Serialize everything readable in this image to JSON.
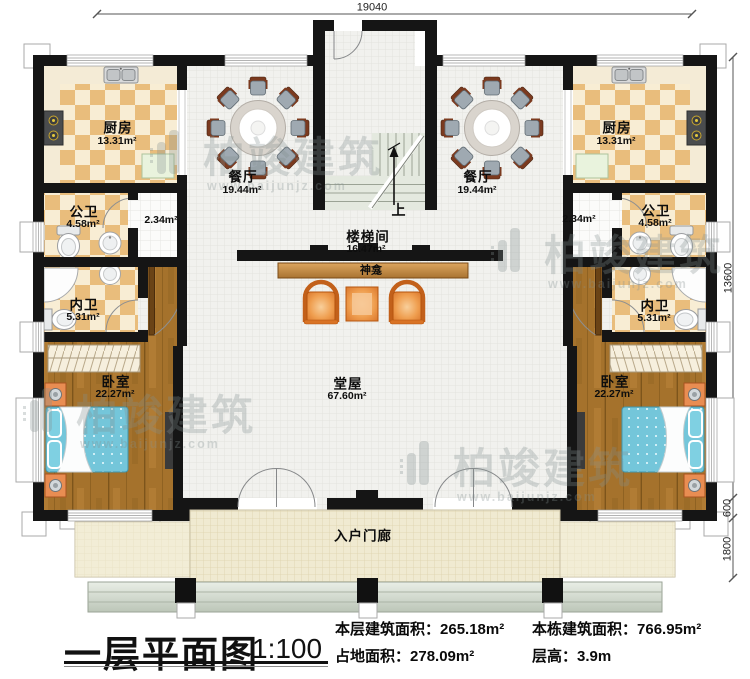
{
  "dimensions": {
    "top_width": "19040",
    "right_height": "13600",
    "right_porch": "600",
    "right_steps": "1800"
  },
  "rooms": {
    "kitchen_left": {
      "name": "厨房",
      "area": "13.31m²"
    },
    "kitchen_right": {
      "name": "厨房",
      "area": "13.31m²"
    },
    "dining_left": {
      "name": "餐厅",
      "area": "19.44m²"
    },
    "dining_right": {
      "name": "餐厅",
      "area": "19.44m²"
    },
    "public_bath_left": {
      "name": "公卫",
      "area": "4.58m²"
    },
    "public_bath_right": {
      "name": "公卫",
      "area": "4.58m²"
    },
    "private_bath_left": {
      "name": "内卫",
      "area": "5.31m²"
    },
    "private_bath_right": {
      "name": "内卫",
      "area": "5.31m²"
    },
    "corridor_left": {
      "area": "2.34m²"
    },
    "corridor_right": {
      "area": "2.34m²"
    },
    "bedroom_left": {
      "name": "卧室",
      "area": "22.27m²"
    },
    "bedroom_right": {
      "name": "卧室",
      "area": "22.27m²"
    },
    "stair_hall": {
      "name": "楼梯间",
      "area": "16.47m²"
    },
    "hall": {
      "name": "堂屋",
      "area": "67.60m²"
    },
    "shrine": {
      "name": "神龛"
    },
    "porch": {
      "name": "入户门廊"
    },
    "stair_up": "上"
  },
  "title_block": {
    "title": "一层平面图",
    "scale": "1:100",
    "stats": [
      {
        "label": "本层建筑面积：",
        "value": "265.18m²"
      },
      {
        "label": "占地面积：",
        "value": "278.09m²"
      },
      {
        "label": "本栋建筑面积：",
        "value": "766.95m²"
      },
      {
        "label": "层高：",
        "value": "3.9m"
      }
    ]
  },
  "watermark": {
    "brand": "柏竣建筑",
    "url": "www.baijunjz.com"
  },
  "colors": {
    "wall": "#151515",
    "checker_orange": "#e9bd7c",
    "checker_cream": "#f8edd4",
    "hall_floor": "#f1f1ee",
    "wood_floor": "#a5722c",
    "bed": "#74c6da",
    "nightstand": "#e98d52",
    "porch_floor": "#f0ead1",
    "shrine_wood": "#c9965a",
    "armchair": "#ef9e4f",
    "stairs": "#e4e9df",
    "watermark_gray": "#849090"
  }
}
